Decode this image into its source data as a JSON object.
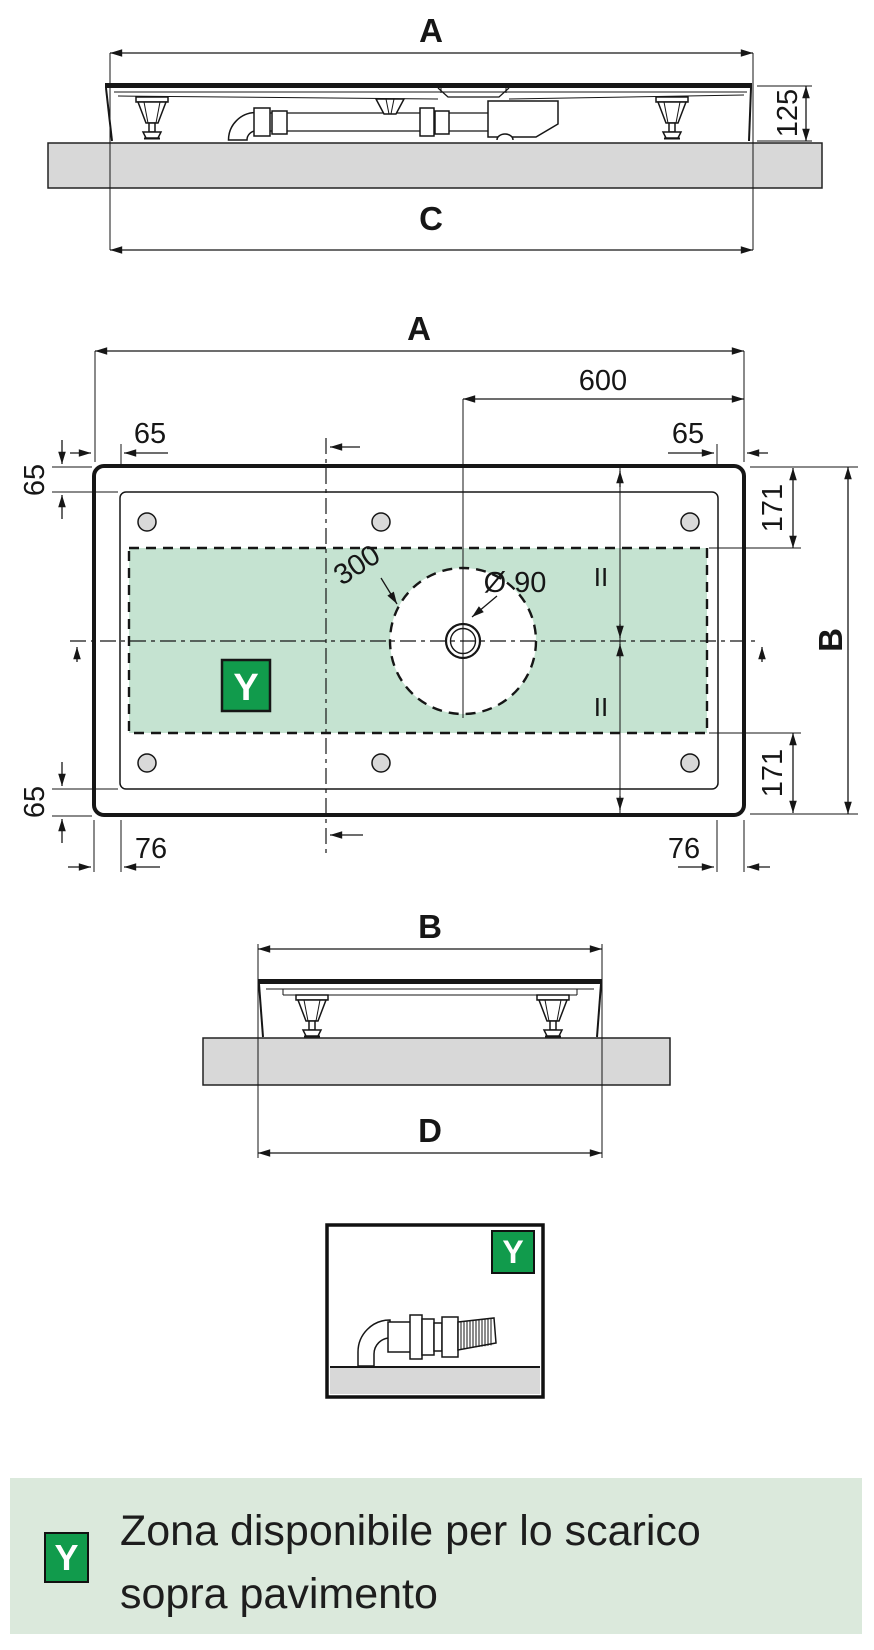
{
  "colors": {
    "accent_green": "#119b4c",
    "zone_fill": "#c5e3d1",
    "legend_bg": "#dbe9dc",
    "slab_gray": "#d8d8d8",
    "line": "#161616"
  },
  "drawing": {
    "dim_a": "A",
    "dim_b": "B",
    "dim_c": "C",
    "dim_d": "D",
    "dim_125": "125",
    "dim_600": "600",
    "dim_65": "65",
    "dim_171": "171",
    "dim_76": "76",
    "dim_300": "300",
    "dim_diameter": "Ø 90",
    "equal_mark": "II",
    "zone_symbol": "Y"
  },
  "legend": {
    "symbol": "Y",
    "line1": "Zona disponibile per lo scarico",
    "line2": "sopra pavimento"
  }
}
